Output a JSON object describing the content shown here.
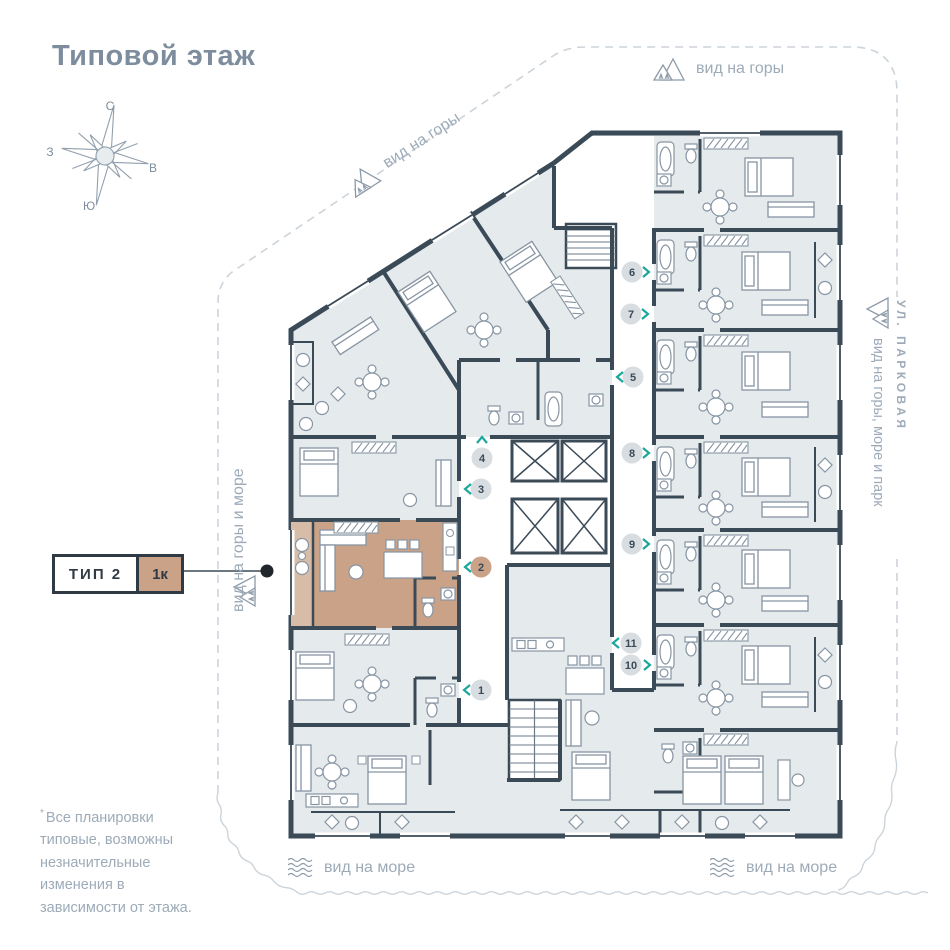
{
  "title": "Типовой этаж",
  "compass": {
    "n": "С",
    "e": "В",
    "s": "Ю",
    "w": "З"
  },
  "labels": {
    "view_mountains_top": "вид на горы",
    "view_mountains_diagonal": "вид на горы",
    "view_mountains_sea_left": "вид на горы и море",
    "view_mountains_sea_park_right": "вид на горы, море и парк",
    "street_right": "УЛ. ПАРКОВАЯ",
    "view_sea_bottom_left": "вид на море",
    "view_sea_bottom_right": "вид на море"
  },
  "callout": {
    "type_label": "ТИП 2",
    "rooms_label": "1к"
  },
  "footnote_marker": "*",
  "footnote": "Все планировки типовые, возможны незначительные изменения в зависимости от этажа.",
  "plan": {
    "units": [
      "1",
      "2",
      "3",
      "4",
      "5",
      "6",
      "7",
      "8",
      "9",
      "10",
      "11"
    ],
    "highlighted_unit": "2"
  },
  "colors": {
    "wall": "#3b4a57",
    "room_fill": "#e5eaed",
    "accent_tan": "#c9a287",
    "accent_tan_light": "#d7bca7",
    "marker_gray": "#d8dde1",
    "teal": "#1ba79c",
    "muted_text": "#9dabb8"
  }
}
